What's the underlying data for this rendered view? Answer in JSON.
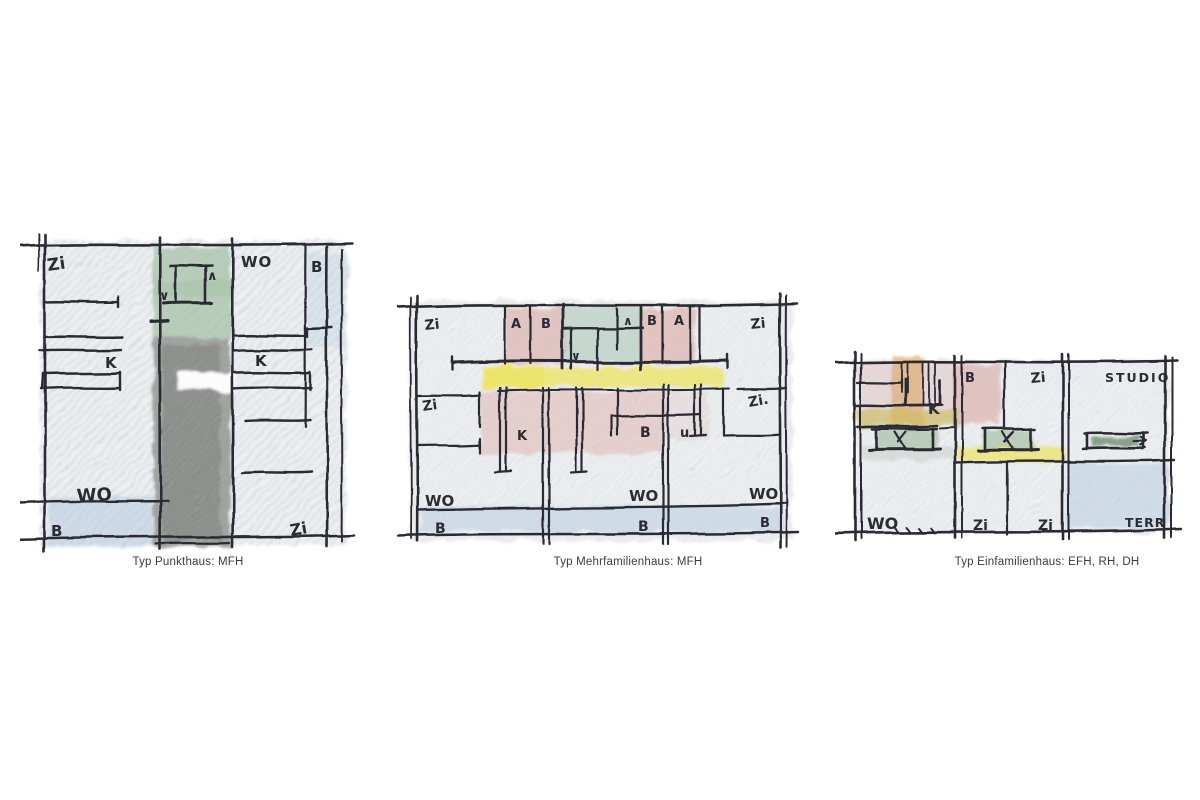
{
  "figure": {
    "panels": [
      {
        "id": "punkthaus",
        "caption": "Typ Punkthaus: MFH",
        "labels": {
          "zi_top": "Zi",
          "wo_top": "WO",
          "b_top": "B",
          "k_left": "K",
          "k_right": "K",
          "wo_bottom": "WO",
          "b_bottom": "B",
          "zi_bottom": "Zi"
        },
        "icons": {
          "up_arrow": "∧",
          "down_arrow": "∨"
        }
      },
      {
        "id": "mehrfamilienhaus",
        "caption": "Typ Mehrfamilienhaus: MFH",
        "labels": {
          "zi_top_left": "Zi",
          "a_top_left": "A",
          "b_top_left": "B",
          "b_top_right": "B",
          "a_top_right": "A",
          "zi_top_right": "Zi",
          "zi_mid_left": "Zi",
          "zi_mid_right": "Zi.",
          "k_mid": "K",
          "b_mid": "B",
          "u_mid": "u",
          "wo_bottom_left": "WO",
          "wo_bottom_mid": "WO",
          "wo_bottom_right": "WO",
          "b_bottom_left": "B",
          "b_bottom_mid": "B",
          "b_bottom_right": "B"
        },
        "icons": {
          "up_arrow": "∧",
          "down_arrow": "∨"
        }
      },
      {
        "id": "einfamilienhaus",
        "caption": "Typ Einfamilienhaus: EFH, RH, DH",
        "labels": {
          "k_top": "K",
          "b_top": "B",
          "zi_top": "Zi",
          "studio_top": "STUDIO",
          "wo_bottom": "WO",
          "zi_bottom_left": "Zi",
          "zi_bottom_right": "Zi",
          "terr_bottom": "TERR"
        }
      }
    ]
  },
  "colors": {
    "ink": "#2b2b33",
    "pencil_hatch": "#c4ccd4",
    "pink": "#dcaaa4",
    "green_sage": "#a6c1a8",
    "green_mint": "#b7cec0",
    "grey_core": "#90928e",
    "yellow": "#ece468",
    "olive": "#cdbf62",
    "orange": "#e2b169",
    "blue": "#b6cadf",
    "green_dark": "#7e9a7f",
    "caption_text": "#3a3a3a"
  }
}
